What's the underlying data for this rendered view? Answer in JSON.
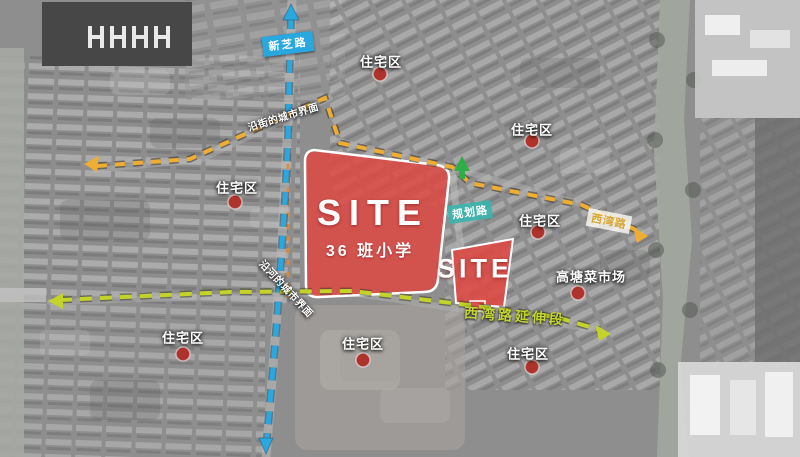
{
  "sites": {
    "main": {
      "title": "SITE",
      "subtitle": "36 班小学"
    },
    "secondary": {
      "title": "SITE"
    }
  },
  "roads": {
    "xinzhi": {
      "label": "新芝路",
      "style": "blue-dashed"
    },
    "planned": {
      "label": "规划路",
      "style": "teal-tag"
    },
    "xiwan": {
      "label": "西湾路",
      "style": "yellow-dashed"
    },
    "xiwan_extension": {
      "label": "西湾路延伸段",
      "style": "green-dashed"
    }
  },
  "interfaces": {
    "street": {
      "label": "沿街的城市界面"
    },
    "river": {
      "label": "沿河的城市界面"
    }
  },
  "pois": {
    "residential": {
      "label": "住宅区",
      "count": 7
    },
    "market": {
      "label": "高塘菜市场"
    }
  },
  "colors": {
    "site_fill": "#dc4a45",
    "road_blue": "#29a8e0",
    "road_yellow": "#eead33",
    "road_green": "#c3d32a",
    "marker_red": "#ad332c",
    "arrow_green": "#2fad49",
    "teal_label_bg": "#3ab5ad"
  }
}
